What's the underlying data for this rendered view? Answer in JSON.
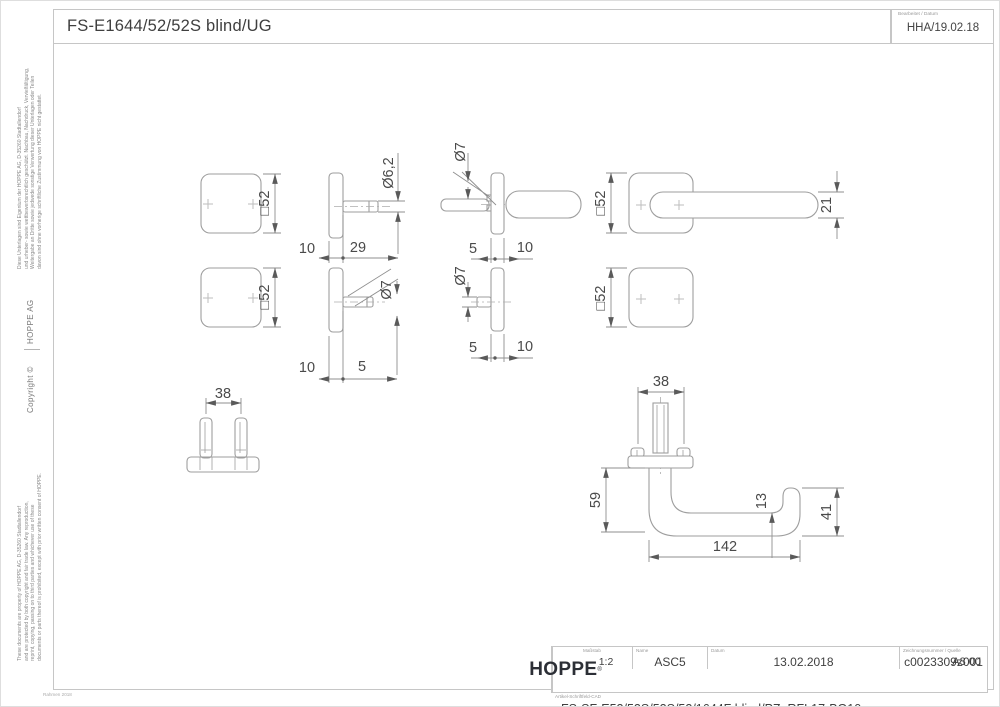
{
  "header": {
    "title": "FS-E1644/52/52S blind/UG",
    "edited_label": "Bearbeitet / Datum",
    "edited_value": "HHA/19.02.18"
  },
  "margin": {
    "notice_de": [
      "Diese Unterlagen sind Eigentum der  HOPPE AG, D-35260 Stadtallendorf",
      "und urheber- sowie wettbewerbsrechtlich geschützt. Nachbau, Nachdruck, Vervielfältigung,",
      "Weitergabe an Dritte sowie jedwede sonstige Verwertung dieser Unterlagen oder Teilen",
      "davon sind ohne vorherige schriftliche Zustimmung von HOPPE nicht gestattet."
    ],
    "company": "HOPPE  AG",
    "copyright": "Copyright ©",
    "notice_en": [
      "These documents are property of HOPPE AG, D-35260 Stadtallendorf",
      "and are protected by both copyright and fair trade law. Any reproduction,",
      "reprint, copying, passing on to third parties and whichever use of these",
      "documents or parts thereof is prohibited, except with prior written consent of HOPPE."
    ],
    "frame_version": "Rahmen 2018"
  },
  "title_block": {
    "scale_label": "Maßstab",
    "scale": "1:2",
    "name_label": "Name",
    "name": "ASC5",
    "date_label": "Datum",
    "date": "13.02.2018",
    "number_label": "Zeichnungsnummer / Quelle",
    "number": "c0023309z001",
    "format": "A3 00",
    "article_label": "Artikel-Schriftfeld-CAD",
    "article": "FS-SF-E52/52S/52S/52/1644F blind/PZ; RFL17-BG10",
    "brand": "HOPPE"
  },
  "dims": {
    "square52": "□52",
    "dia6_2": "Ø6,2",
    "dia7": "Ø7",
    "len5": "5",
    "len10": "10",
    "len13": "13",
    "len21": "21",
    "len29": "29",
    "len38": "38",
    "len41": "41",
    "len59": "59",
    "len142": "142"
  }
}
